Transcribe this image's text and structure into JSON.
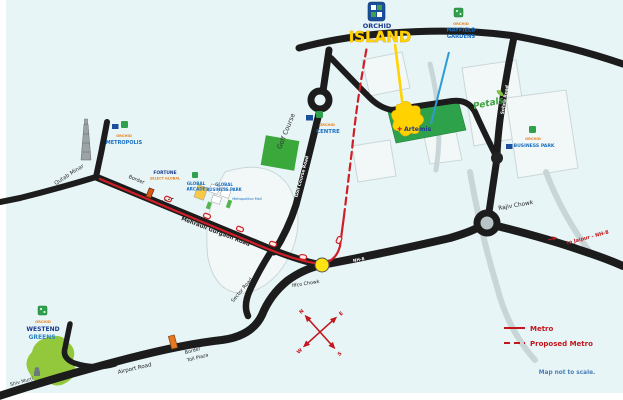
{
  "map": {
    "title": {
      "brand": "ORCHID",
      "name": "ISLAND"
    },
    "legend": {
      "metro": "Metro",
      "proposed_metro": "Proposed Metro",
      "disclaimer": "Map not to scale."
    },
    "compass": {
      "n": "N",
      "e": "E",
      "s": "S",
      "w": "W"
    },
    "roads": {
      "mg_road": "Mehrauli Gurgaon Road",
      "golf_course_road": "Golf Course Road",
      "sector_road": "Sector Road",
      "sohna_road": "Sohna Road",
      "airport_road": "Airport Road",
      "nh8": "NH-8",
      "to_jaipur": "to Jaipur - NH-8"
    },
    "junctions": {
      "iffco_chowk": "Iffco Chowk",
      "rajiv_chowk": "Rajiv Chowk"
    },
    "landmarks": {
      "qutab_minar": "Qutab Minar",
      "border": "Border",
      "border_toll_line1": "Border",
      "border_toll_line2": "Toll Plaza",
      "shiv_murti": "Shiv Murti",
      "golf_course": "Golf Course",
      "artemis": "Artemis",
      "artemis_cross": "✚",
      "metropolitan_mall": "Metropolitan Mall"
    },
    "projects": {
      "mayfield": {
        "brand": "ORCHID",
        "line1": "MAYFIELD",
        "line2": "GARDENS"
      },
      "metropolis": {
        "brand": "ORCHID",
        "name": "METROPOLIS"
      },
      "centre": {
        "brand": "ORCHID",
        "name": "CENTRE"
      },
      "fortune": {
        "line1": "FORTUNE",
        "line2": "SELECT GLOBAL"
      },
      "global_arcade": {
        "line1": "GLOBAL",
        "line2": "ARCADE"
      },
      "global_business_park": {
        "line1": "GLOBAL",
        "line2": "BUSINESS PARK"
      },
      "petals": {
        "name": "Petals"
      },
      "business_park": {
        "brand": "ORCHID",
        "name": "BUSINESS PARK"
      },
      "westend": {
        "brand": "ORCHID",
        "line1": "WESTEND",
        "line2": "GREENS"
      }
    },
    "colors": {
      "background": "#e7f5f7",
      "road": "#1c1c1c",
      "metro_red": "#cf1e26",
      "accent_yellow": "#ffd200",
      "map_green": "#2ea24a",
      "label_blue": "#1b6fc0",
      "brand_orange": "#e8821e"
    }
  }
}
